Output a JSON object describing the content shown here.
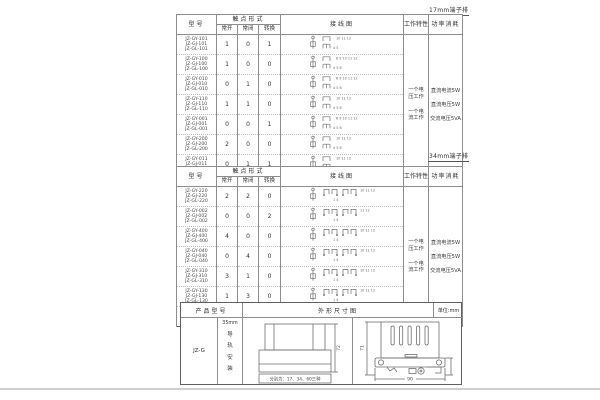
{
  "page": {
    "bg": "#ffffff",
    "ink": "#3d3d3d",
    "border": "#8d8d8d",
    "rule": "#cfcfcf"
  },
  "table17": {
    "corner_label": "17mm端子排",
    "headers": {
      "model": "型号",
      "contact": "触点形式",
      "no": "常开",
      "nc": "常闭",
      "co": "转换",
      "wiring": "接线图",
      "work": "工作特性",
      "power": "功率消耗"
    },
    "working": [
      "一个电压工作",
      "一个电流工作"
    ],
    "power": [
      "直流电流5W",
      "直流电压5W",
      "交流电压5VA"
    ],
    "rows": [
      {
        "models": [
          "JZ-GY-101",
          "JZ-GJ-101",
          "JZ-GL-101"
        ],
        "no": "1",
        "nc": "0",
        "co": "1",
        "t": "10 11 12",
        "b": "4 5"
      },
      {
        "models": [
          "JZ-GY-100",
          "JZ-GJ-100",
          "JZ-GL-100"
        ],
        "no": "1",
        "nc": "0",
        "co": "0",
        "t": "8 9 10 11 12",
        "b": "4 5 6"
      },
      {
        "models": [
          "JZ-GY-010",
          "JZ-GJ-010",
          "JZ-GL-010"
        ],
        "no": "0",
        "nc": "1",
        "co": "0",
        "t": "8 9 10 11 12",
        "b": "4 5 6"
      },
      {
        "models": [
          "JZ-GY-110",
          "JZ-GJ-110",
          "JZ-GL-110"
        ],
        "no": "1",
        "nc": "1",
        "co": "0",
        "t": "10 11 12",
        "b": "4 5 6"
      },
      {
        "models": [
          "JZ-GY-001",
          "JZ-GJ-001",
          "JZ-GL-001"
        ],
        "no": "0",
        "nc": "0",
        "co": "1",
        "t": "8 9 10 11 12",
        "b": "4 5 6"
      },
      {
        "models": [
          "JZ-GY-200",
          "JZ-GJ-200",
          "JZ-GL-200"
        ],
        "no": "2",
        "nc": "0",
        "co": "0",
        "t": "10 11 12",
        "b": "4 5 6"
      },
      {
        "models": [
          "JZ-GY-011",
          "JZ-GJ-011",
          "JZ-GL-011"
        ],
        "no": "0",
        "nc": "1",
        "co": "1",
        "t": "10 11 12",
        "b": "4 5 6"
      }
    ]
  },
  "table34": {
    "corner_label": "34mm端子排",
    "headers": {
      "model": "型号",
      "contact": "触点形式",
      "no": "常开",
      "nc": "常闭",
      "co": "转换",
      "wiring": "接线图",
      "work": "工作特性",
      "power": "功率消耗"
    },
    "working": [
      "一个电压工作",
      "一个电流工作"
    ],
    "power": [
      "直流电流5W",
      "直流电压5W",
      "交流电压5VA"
    ],
    "rows": [
      {
        "models": [
          "JZ-GY-220",
          "JZ-GJ-220",
          "JZ-GL-220"
        ],
        "no": "2",
        "nc": "2",
        "co": "0",
        "t": "10 11 12",
        "b": "1 4"
      },
      {
        "models": [
          "JZ-GY-002",
          "JZ-GJ-002",
          "JZ-GL-002"
        ],
        "no": "0",
        "nc": "0",
        "co": "2",
        "t": "11 12",
        "b": "1 4"
      },
      {
        "models": [
          "JZ-GY-400",
          "JZ-GJ-400",
          "JZ-GL-400"
        ],
        "no": "4",
        "nc": "0",
        "co": "0",
        "t": "10 11 12",
        "b": "1 4"
      },
      {
        "models": [
          "JZ-GY-040",
          "JZ-GJ-040",
          "JZ-GL-040"
        ],
        "no": "0",
        "nc": "4",
        "co": "0",
        "t": "10 11 12",
        "b": "1 4"
      },
      {
        "models": [
          "JZ-GY-310",
          "JZ-GJ-310",
          "JZ-GL-310"
        ],
        "no": "3",
        "nc": "1",
        "co": "0",
        "t": "10 11 12",
        "b": "1 4"
      },
      {
        "models": [
          "JZ-GY-130",
          "JZ-GJ-130",
          "JZ-GL-130"
        ],
        "no": "1",
        "nc": "3",
        "co": "0",
        "t": "10 11 12",
        "b": "1 4"
      },
      {
        "models": [
          "JZ-GY-112",
          "JZ-GJ-112",
          "JZ-GL-112"
        ],
        "no": "1",
        "nc": "1",
        "co": "2",
        "t": "11 12",
        "b": "1 4"
      }
    ]
  },
  "bottom": {
    "headers": {
      "product": "产品型号",
      "outline": "外形尺寸图",
      "unit": "单位:mm"
    },
    "model": "JZ-G",
    "mount_top": "35mm",
    "mount_vertical": "导轨安装",
    "front": {
      "height": "72",
      "caption": "分别为：17、34、60三种"
    },
    "side": {
      "height": "71",
      "width": "90"
    }
  }
}
